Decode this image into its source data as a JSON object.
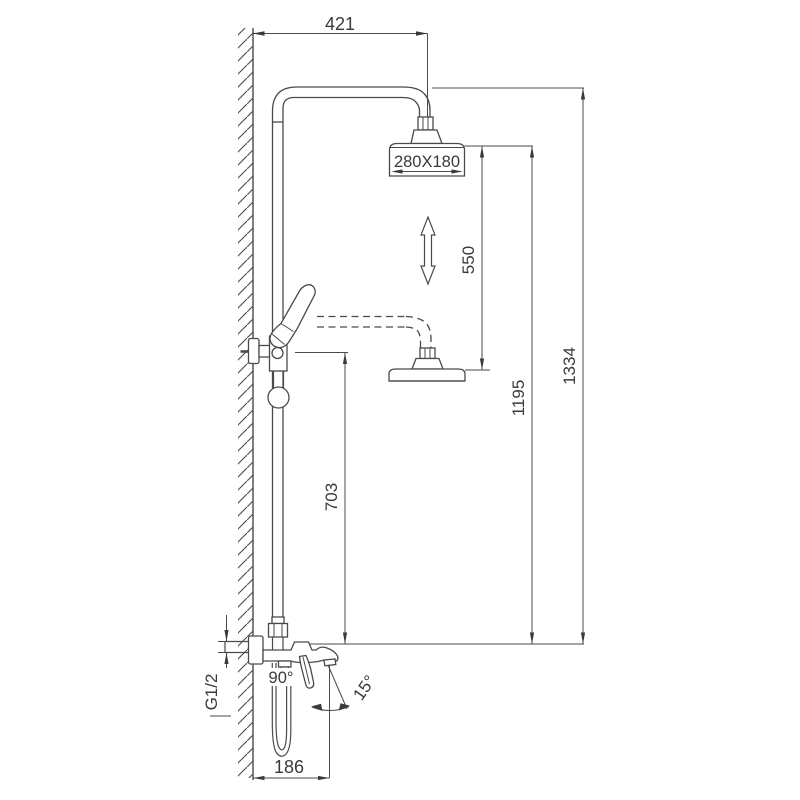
{
  "meta": {
    "title": "Shower column technical dimension drawing",
    "units": "mm"
  },
  "colors": {
    "line": "#4a4a4a",
    "text": "#3a3a3a",
    "background": "#ffffff"
  },
  "labels": {
    "dim_top_offset": "421",
    "dim_head_size": "280X180",
    "dim_height_adjust": "550",
    "dim_lower_head_height": "1195",
    "dim_total_height": "1334",
    "dim_hand_shower_height": "703",
    "dim_spout_reach": "186",
    "dim_inlet_thread": "G1/2",
    "dim_hose_angle": "90°",
    "dim_spray_angle": "15°"
  }
}
